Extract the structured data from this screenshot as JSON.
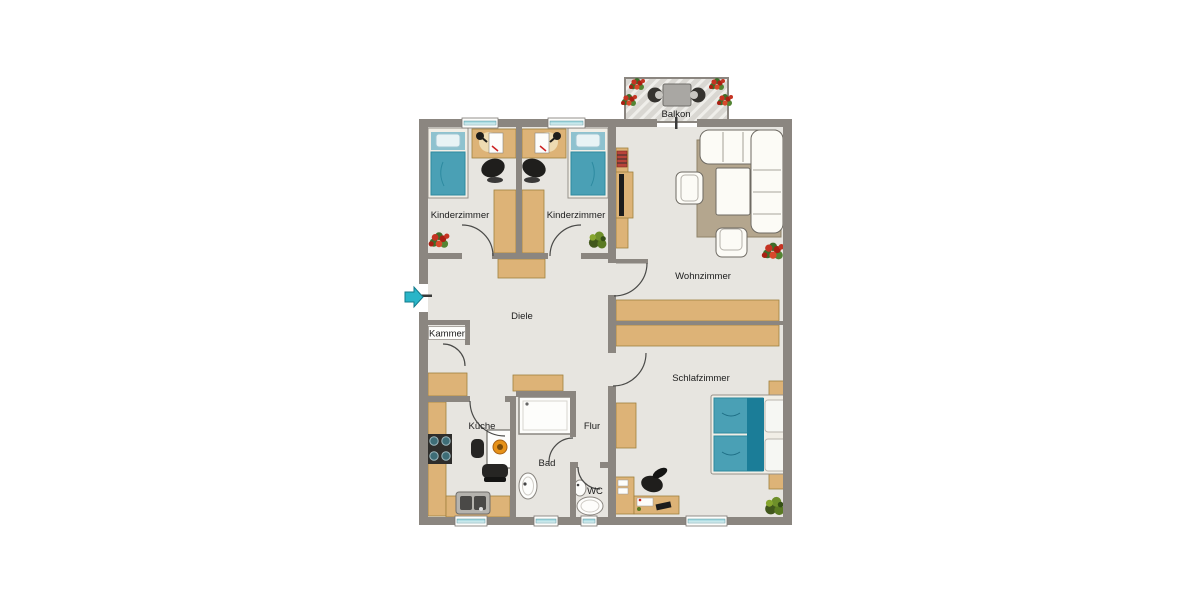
{
  "plan": {
    "type": "apartment-floorplan",
    "rooms": {
      "balkon": {
        "label": "Balkon"
      },
      "kinderzimmer_links": {
        "label": "Kinderzimmer"
      },
      "kinderzimmer_rechts": {
        "label": "Kinderzimmer"
      },
      "wohnzimmer": {
        "label": "Wohnzimmer"
      },
      "schlafzimmer": {
        "label": "Schlafzimmer"
      },
      "diele": {
        "label": "Diele"
      },
      "kammer": {
        "label": "Kammer"
      },
      "kueche": {
        "label": "Küche"
      },
      "flur": {
        "label": "Flur"
      },
      "bad": {
        "label": "Bad"
      },
      "wc": {
        "label": "WC"
      }
    }
  },
  "colors": {
    "wall": "#8b8680",
    "floor": "#e7e5e0",
    "balcony_floor": "#d9d7d2",
    "wood_furniture": "#ddb377",
    "bed_teal": "#4aa0b5",
    "bed_teal_dark": "#1b7d98",
    "white_furniture": "#fcfbf6",
    "rug": "#b4a68e",
    "entrance_arrow": "#2ab5c8",
    "flower_red": "#c53322",
    "plant_green": "#5a7a22",
    "window_glass": "#8fcfd8",
    "label_text": "#1c1c1c"
  }
}
